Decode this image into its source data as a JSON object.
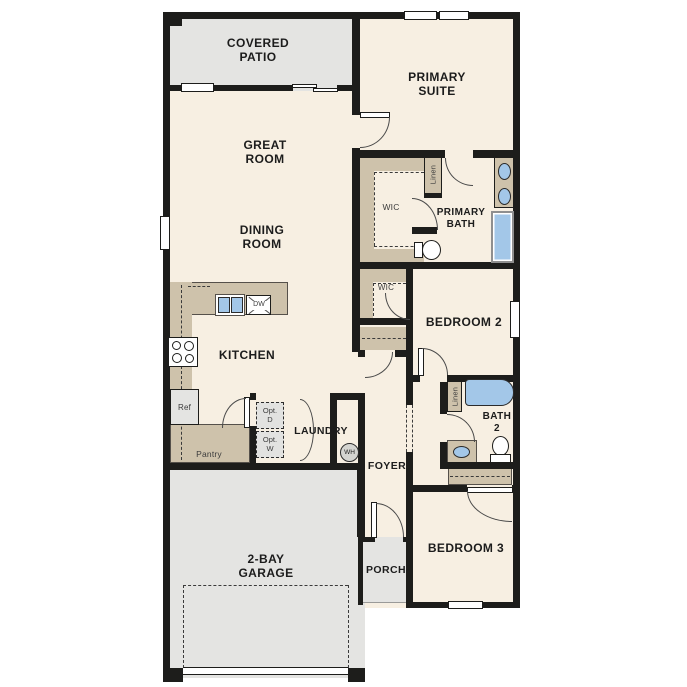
{
  "title": "Single-story house floor plan",
  "colors": {
    "floor": "#f7efe2",
    "outdoor": "#e4e4e2",
    "casework": "#cec2ab",
    "water": "#a3c7e8",
    "wall": "#1d1d1b"
  },
  "rooms": {
    "covered_patio": [
      "COVERED",
      "PATIO"
    ],
    "great_room": [
      "GREAT",
      "ROOM"
    ],
    "dining_room": [
      "DINING",
      "ROOM"
    ],
    "primary_suite": [
      "PRIMARY",
      "SUITE"
    ],
    "primary_bath": [
      "PRIMARY",
      "BATH"
    ],
    "bath_2": [
      "BATH",
      "2"
    ],
    "garage": [
      "2-BAY",
      "GARAGE"
    ],
    "kitchen": "KITCHEN",
    "bedroom_2": "BEDROOM 2",
    "bedroom_3": "BEDROOM 3",
    "laundry": "LAUNDRY",
    "foyer": "FOYER",
    "porch": "PORCH"
  },
  "closets": {
    "wic_primary": "WIC",
    "wic_bedroom2": "WIC",
    "linen_primary": "Linen",
    "linen_hall": "Linen",
    "pantry": "Pantry"
  },
  "fixtures": {
    "dishwasher": "DW",
    "refrigerator": "Ref",
    "water_heater": "WH",
    "optional_dryer": [
      "Opt.",
      "D"
    ],
    "optional_washer": [
      "Opt.",
      "W"
    ]
  }
}
